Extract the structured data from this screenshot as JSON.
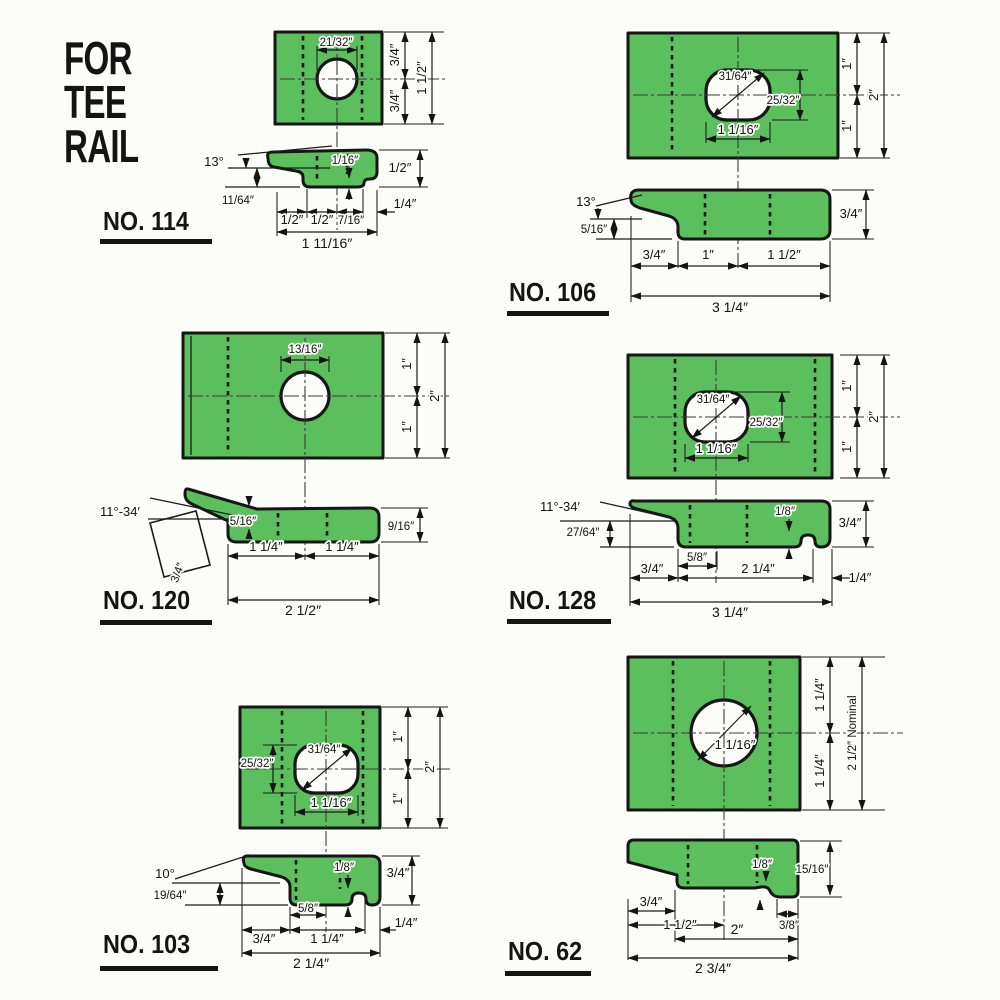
{
  "title": {
    "line1": "FOR",
    "line2": "TEE",
    "line3": "RAIL"
  },
  "colors": {
    "green": "#5abf5c",
    "ink": "#161616",
    "paper": "#fcfcf9"
  },
  "parts": {
    "no114": {
      "label": "NO. 114",
      "top": {
        "hole_width": "21/32″",
        "upper": "3/4″",
        "lower": "3/4″",
        "height": "1 1/2″"
      },
      "side": {
        "angle": "13°",
        "tip": "11/64″",
        "step": "1/16″",
        "thick": "1/2″",
        "d1": "1/2″",
        "d2": "1/2″",
        "d3": "7/16″",
        "d4": "1/4″",
        "total": "1 11/16″"
      }
    },
    "no106": {
      "label": "NO. 106",
      "top": {
        "diag": "31/64″",
        "slot_height": "25/32″",
        "slot_width": "1 1/16″",
        "upper": "1″",
        "lower": "1″",
        "height": "2″"
      },
      "side": {
        "angle": "13°",
        "lip": "5/16″",
        "thick": "3/4″",
        "d1": "3/4″",
        "d2": "1″",
        "d3": "1 1/2″",
        "total": "3 1/4″"
      }
    },
    "no120": {
      "label": "NO. 120",
      "top": {
        "hole": "13/16″",
        "upper": "1″",
        "lower": "1″",
        "height": "2″"
      },
      "side": {
        "angle": "11°-34′",
        "square": "3/4″",
        "lip": "5/16″",
        "thick": "9/16″",
        "d1": "1 1/4″",
        "d2": "1 1/4″",
        "total": "2 1/2″"
      }
    },
    "no128": {
      "label": "NO. 128",
      "top": {
        "diag": "31/64″",
        "slot_height": "25/32″",
        "slot_width": "1 1/16″",
        "upper": "1″",
        "lower": "1″",
        "height": "2″"
      },
      "side": {
        "angle": "11°-34′",
        "lip": "27/64″",
        "notch": "1/8″",
        "thick": "3/4″",
        "d1": "3/4″",
        "d2": "5/8″",
        "d3": "2 1/4″",
        "d4": "1/4″",
        "total": "3 1/4″"
      }
    },
    "no103": {
      "label": "NO. 103",
      "top": {
        "slot_height": "25/32″",
        "diag": "31/64″",
        "slot_width": "1 1/16″",
        "upper": "1″",
        "lower": "1″",
        "height": "2″"
      },
      "side": {
        "angle": "10°",
        "lip": "19/64″",
        "notch": "1/8″",
        "thick": "3/4″",
        "d1": "5/8″",
        "d2": "3/4″",
        "d3": "1 1/4″",
        "d4": "1/4″",
        "total": "2 1/4″"
      }
    },
    "no62": {
      "label": "NO. 62",
      "top": {
        "hole": "1 1/16″",
        "upper": "1 1/4″",
        "lower": "1 1/4″",
        "height": "2 1/2″ Nominal"
      },
      "side": {
        "notch": "1/8″",
        "thick": "15/16″",
        "d1": "3/4″",
        "d2": "1 1/2″",
        "d3": "2″",
        "d4": "3/8″",
        "total": "2 3/4″"
      }
    }
  }
}
